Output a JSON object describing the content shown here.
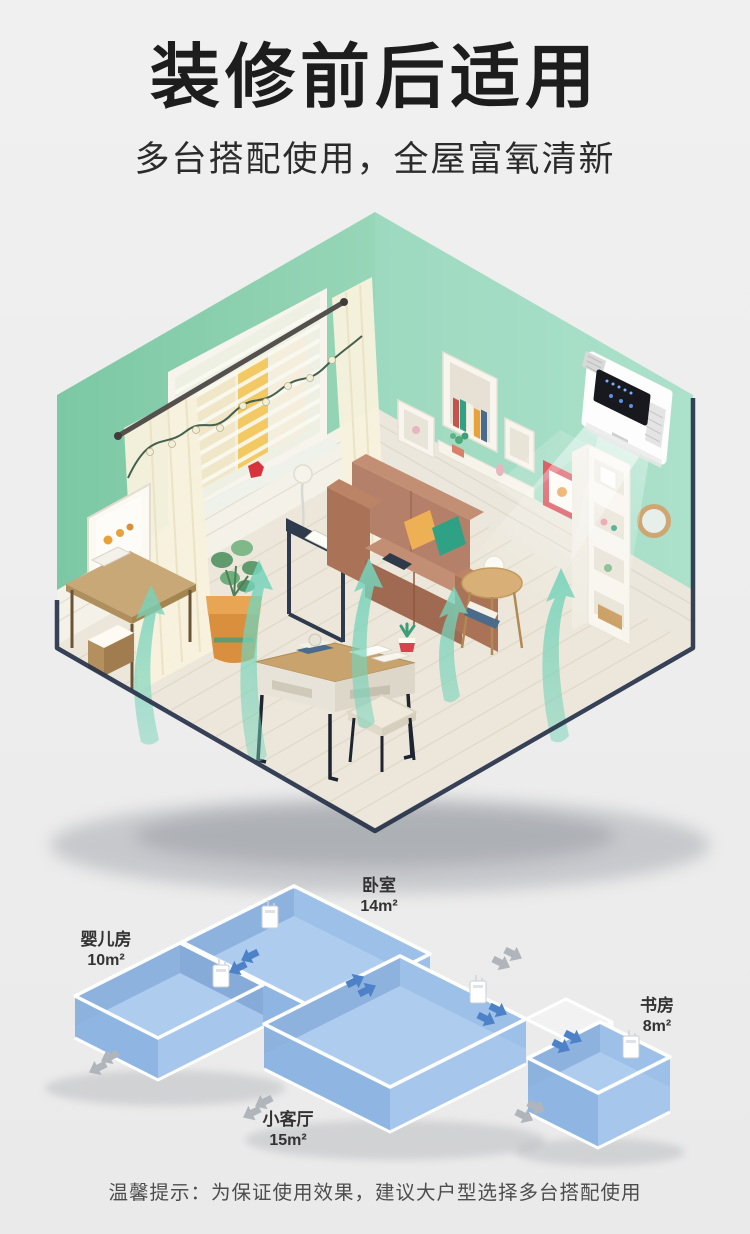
{
  "header": {
    "title": "装修前后适用",
    "subtitle": "多台搭配使用，全屋富氧清新"
  },
  "room_scene": {
    "description": "isometric-living-room-with-wall-mounted-fresh-air-unit",
    "colors": {
      "wall_left": "#84cdab",
      "wall_right": "#a2dbc2",
      "wainscot": "#f3f0e6",
      "floor": "#ece7da",
      "sofa": "#b5806a",
      "pillow_yellow": "#eeb054",
      "pillow_green": "#2fa184",
      "airflow": "#76d3ba",
      "device_body": "#fdfdfd",
      "device_screen": "#17191e"
    }
  },
  "floor_plan": {
    "description": "isometric-apartment-airflow-diagram",
    "colors": {
      "room_floor": "#a9c7e8",
      "room_rim": "#c4d9f0",
      "wall_inner": "#87abd8",
      "arrow_in": "#4e82c8",
      "arrow_out": "#b0b5bb"
    },
    "rooms": [
      {
        "name": "婴儿房",
        "area": "10m²"
      },
      {
        "name": "卧室",
        "area": "14m²"
      },
      {
        "name": "小客厅",
        "area": "15m²"
      },
      {
        "name": "书房",
        "area": "8m²"
      }
    ]
  },
  "footer": {
    "tip": "温馨提示：为保证使用效果，建议大户型选择多台搭配使用"
  }
}
